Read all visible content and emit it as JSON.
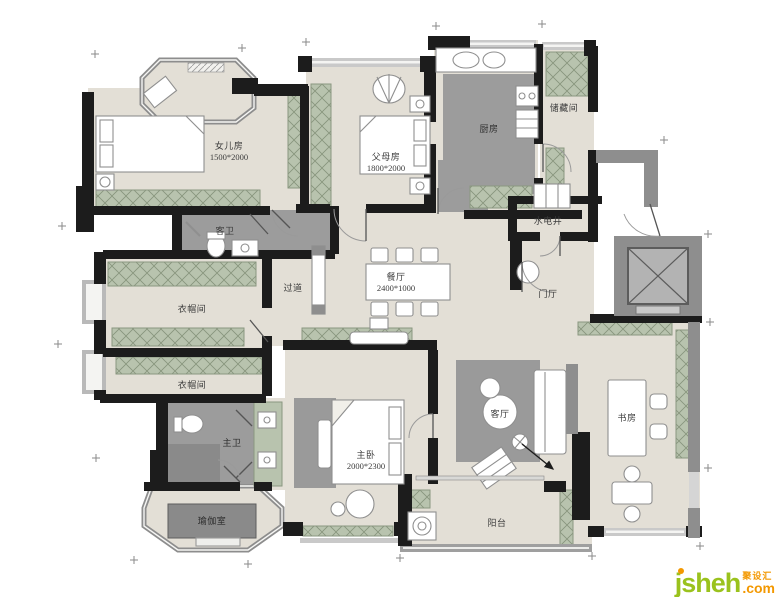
{
  "rooms": {
    "daughter": {
      "label": "女儿房",
      "dim": "1500*2000"
    },
    "guest_bath": {
      "label": "客卫"
    },
    "parents": {
      "label": "父母房",
      "dim": "1800*2000"
    },
    "kitchen": {
      "label": "厨房"
    },
    "storage": {
      "label": "储藏间"
    },
    "utility_shaft": {
      "label": "水电井"
    },
    "corridor": {
      "label": "过道"
    },
    "dining": {
      "label": "餐厅",
      "dim": "2400*1000"
    },
    "foyer": {
      "label": "门厅"
    },
    "cloak_upper": {
      "label": "衣帽间"
    },
    "cloak_lower": {
      "label": "衣帽间"
    },
    "master_bath": {
      "label": "主卫"
    },
    "master": {
      "label": "主卧",
      "dim": "2000*2300"
    },
    "yoga": {
      "label": "瑜伽室"
    },
    "living": {
      "label": "客厅"
    },
    "study": {
      "label": "书房"
    },
    "balcony": {
      "label": "阳台"
    }
  },
  "logo": {
    "brand": "jsheh",
    "cn": "聚设汇",
    "tld": ".com"
  },
  "colors": {
    "floor": "#e3dfd6",
    "wet": "#9c9c9c",
    "wall": "#1c1c1c",
    "gray_wall": "#8e8e8e",
    "cabinet": "#b8c3ae",
    "logo_green": "#9ac21d",
    "logo_orange": "#f39800"
  }
}
